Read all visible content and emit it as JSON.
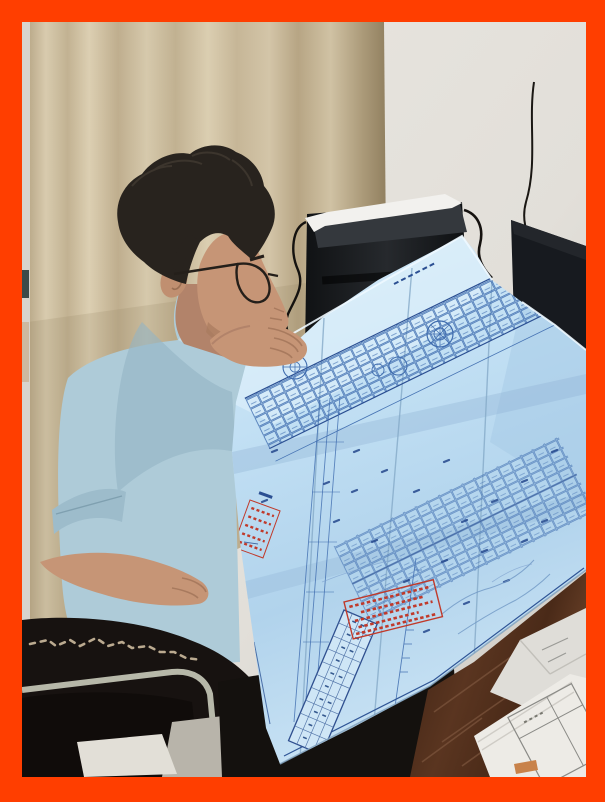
{
  "image_type": "photograph",
  "photo": {
    "description": "A man with short dark hair and glasses, wearing a light blue polo shirt, sits in a worn black leather office chair and leans over a large unfolded light-blue architectural blueprint, holding its top edge with his right hand and its lower-left edge with his left hand. Behind him are beige curtains, a light gray wall, a black computer tower with a sheet of white paper on top, and dark monitor panels. The blueprint shows a dense floor plan with blue linework, a title-block table along its lower-left border, and two red approval stamps with illegible Chinese seal text. In the lower left are the chair's scuffed armrest and chrome frame over a gray floor; in the lower right, a dark brown wooden desk holds a stack of white papers. The whole photo is surrounded by a thick orange-red border.",
    "border_color": "#ff3e00",
    "elements": {
      "curtain": {
        "label": "beige curtain backdrop",
        "color": "#cfc1a3",
        "fold_shadow_color": "#ab9a79"
      },
      "wall": {
        "label": "light gray wall",
        "color": "#e6e3dd"
      },
      "computer_tower": {
        "label": "black PC tower with white paper on top",
        "color": "#1b1d20",
        "paper_color": "#f2f1ee",
        "cable_color": "#15120f"
      },
      "monitor": {
        "label": "dark monitor panel",
        "color": "#171a1f"
      },
      "person": {
        "label": "man reading blueprint",
        "hair_color": "#28231e",
        "skin_color": "#c69576",
        "shirt_color": "#aecbd8",
        "glasses_color": "#241f1a"
      },
      "blueprint": {
        "label": "unfolded architectural floor-plan blueprint",
        "paper_color": "#bcdcf2",
        "highlight_color": "#d9edfa",
        "line_color": "#3f6cae",
        "dark_line_color": "#24478c",
        "stamp_color": "#c03a2b",
        "stamps": [
          {
            "name": "small-red-seal",
            "text_legible": false
          },
          {
            "name": "large-red-approval-stamp",
            "text_legible": false
          }
        ],
        "title_block": {
          "name": "title-block-table",
          "text_legible": false
        }
      },
      "chair": {
        "label": "worn black leather office chair",
        "leather_color": "#171210",
        "scuff_color": "#cdbb9e",
        "chrome_color": "#b7b8a9"
      },
      "floor": {
        "label": "gray concrete floor",
        "color": "#b8b4aa",
        "light_patch_color": "#e2dfd7"
      },
      "desk": {
        "label": "dark brown wooden desk",
        "color": "#52301f"
      },
      "papers": {
        "label": "stack of white documents on desk",
        "color": "#edebe6",
        "form_line_color": "#8a8a86",
        "handwriting_legible": false
      }
    }
  }
}
